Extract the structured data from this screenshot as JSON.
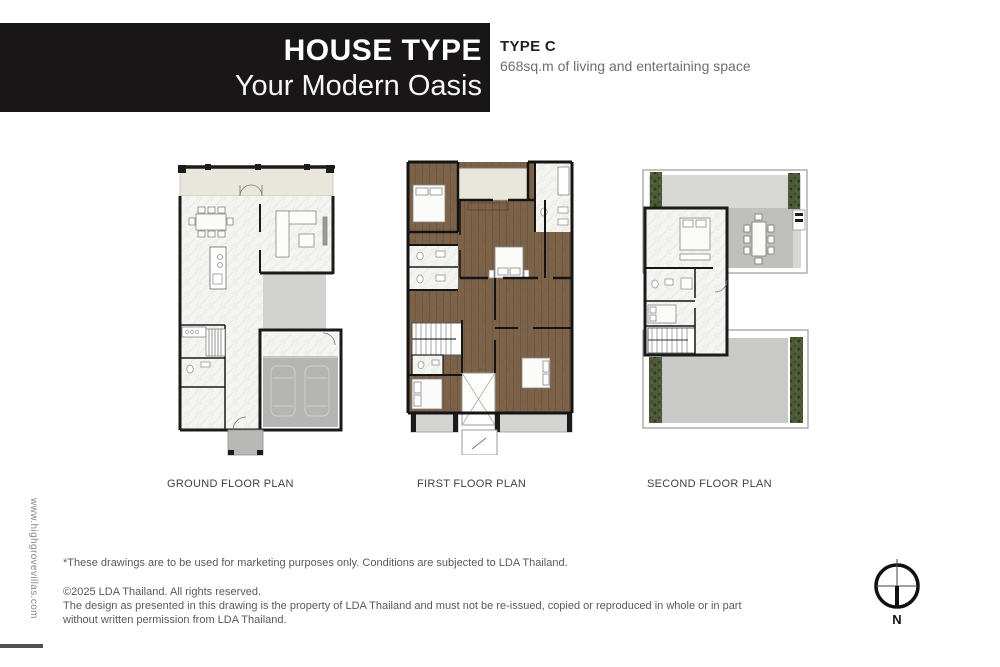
{
  "header": {
    "title": "HOUSE TYPE",
    "subtitle": "Your Modern Oasis",
    "type_label": "TYPE C",
    "type_description": "668sq.m of living and entertaining space"
  },
  "plans": [
    {
      "label": "GROUND FLOOR PLAN"
    },
    {
      "label": "FIRST FLOOR PLAN"
    },
    {
      "label": "SECOND FLOOR PLAN"
    }
  ],
  "footer": {
    "disclaimer": "*These drawings are to be used for marketing purposes only. Conditions are subjected to LDA Thailand.",
    "copyright_line1": "©2025 LDA Thailand. All rights reserved.",
    "copyright_line2": "The design as presented in this drawing is the property of LDA Thailand and must not be re-issued, copied or reproduced in whole or in part",
    "copyright_line3": "without written permission from LDA Thailand."
  },
  "sidebar": {
    "website": "www.highgrovevillas.com"
  },
  "compass": {
    "north_label": "N"
  },
  "colors": {
    "header_bg": "#191617",
    "wall": "#1b1b1b",
    "terrace_beige": "#e9e6db",
    "marble_floor": "#f4f4f1",
    "wood_floor": "#7b6249",
    "courtyard_gray": "#d2d2d0",
    "garage_gray": "#b5b5b3",
    "deck_gray": "#c9c9c7",
    "hedge_green": "#4d5a38"
  }
}
